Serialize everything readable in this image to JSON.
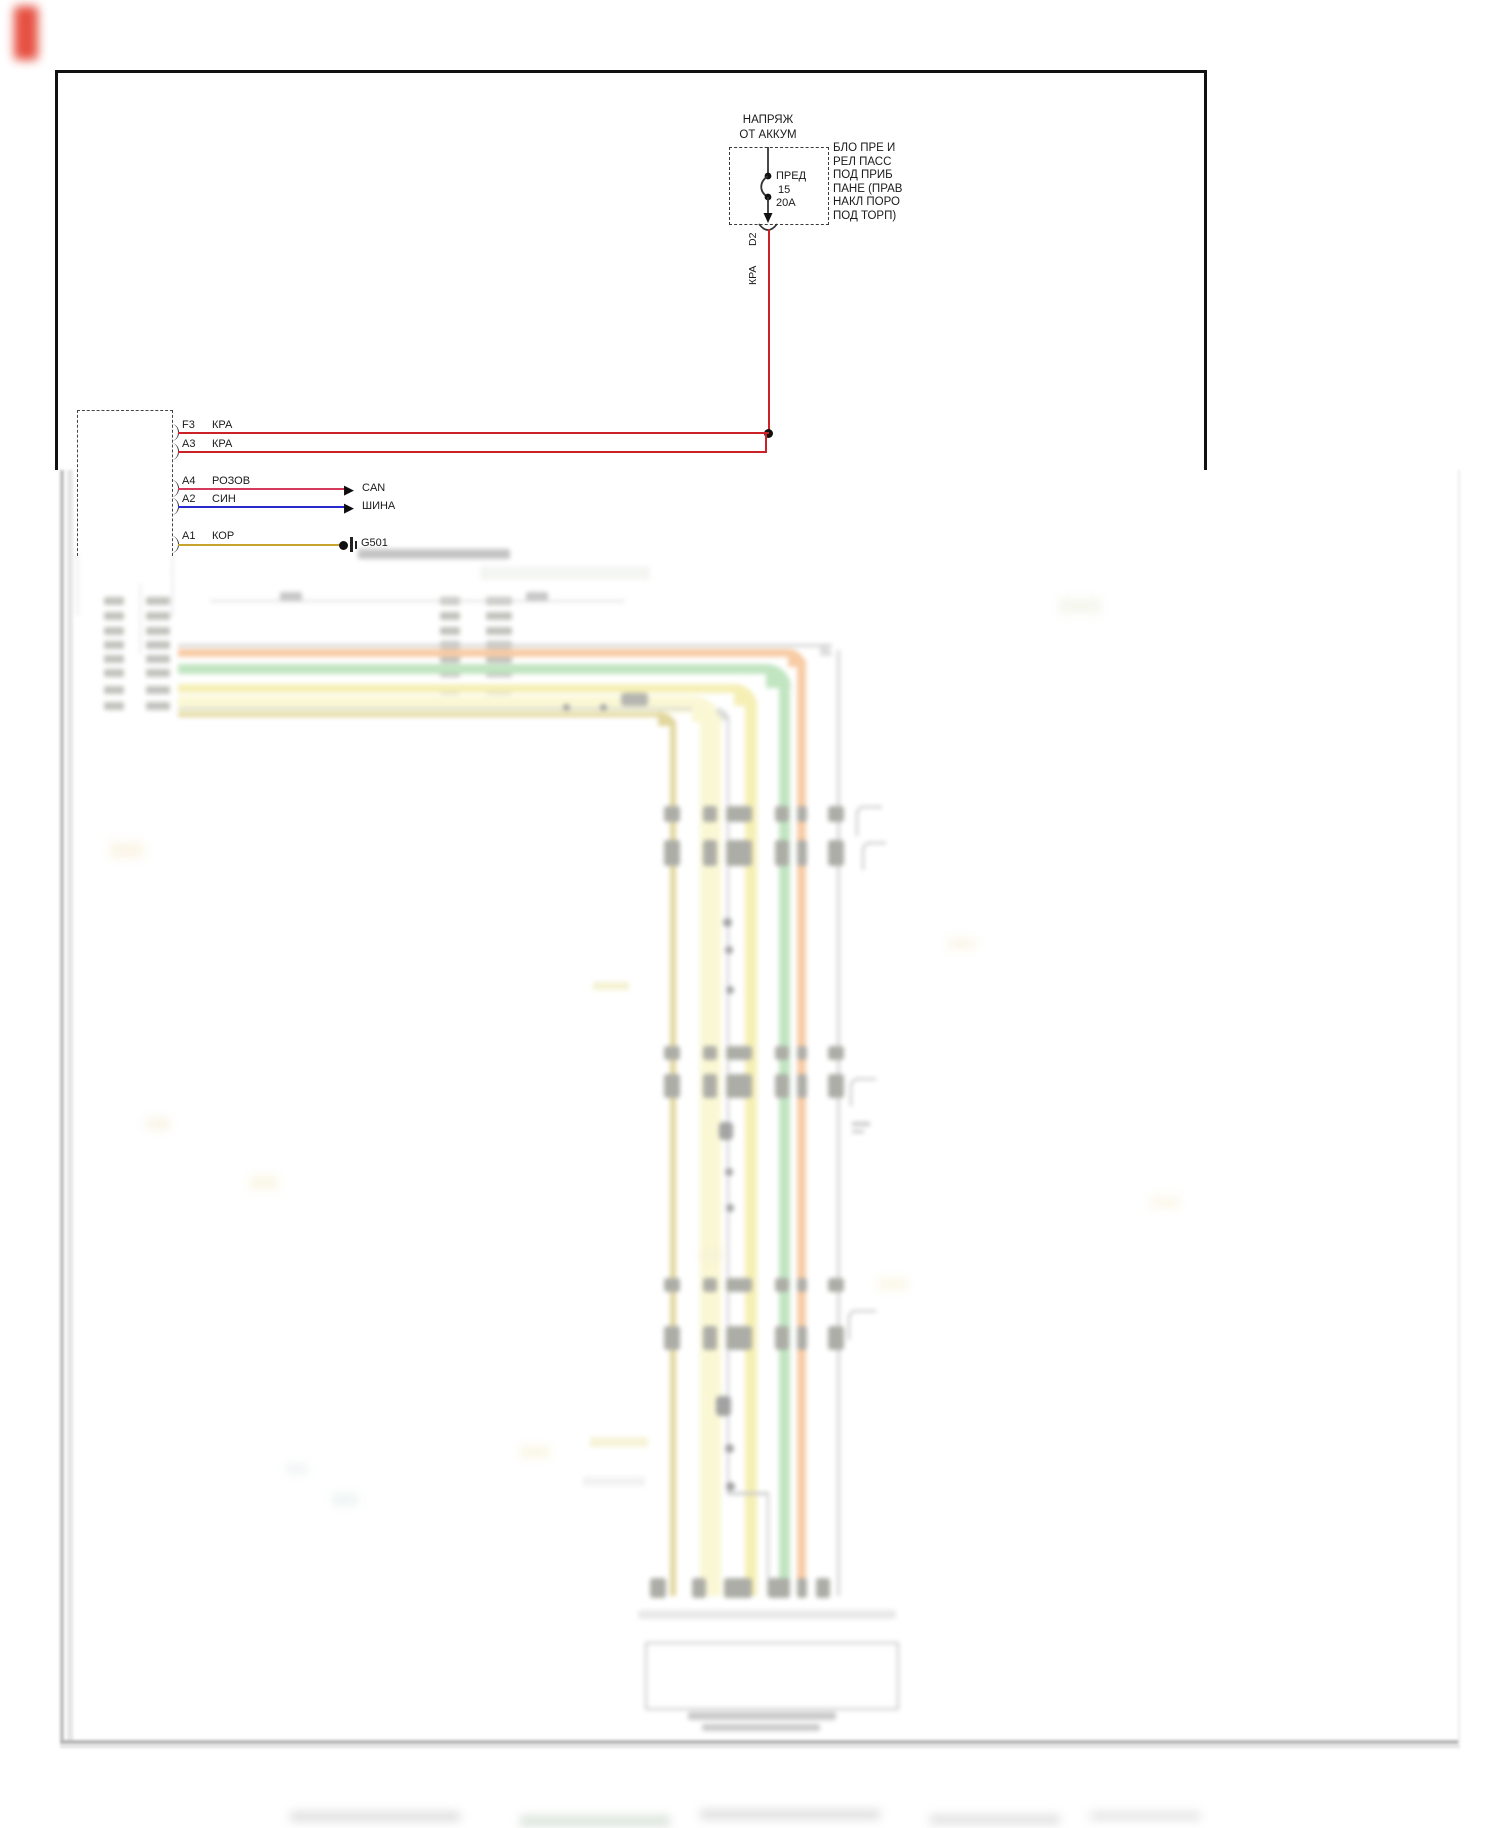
{
  "diagram": {
    "power_source": {
      "line1": "НАПРЯЖ",
      "line2": "ОТ АККУМ"
    },
    "fuse": {
      "name": "ПРЕД",
      "number": "15",
      "rating": "20A"
    },
    "fuse_box_note": {
      "line1": "БЛО ПРЕ И",
      "line2": "РЕЛ ПАСС",
      "line3": "ПОД ПРИБ",
      "line4": "ПАНЕ (ПРАВ",
      "line5": "НАКЛ ПОРО",
      "line6": "ПОД ТОРП)"
    },
    "feed_wire": {
      "pin": "D2",
      "color_label": "КРА",
      "color_hex": "#cc2127"
    },
    "pins": [
      {
        "pin": "F3",
        "color_label": "КРА",
        "dest": ""
      },
      {
        "pin": "A3",
        "color_label": "КРА",
        "dest": ""
      },
      {
        "pin": "A4",
        "color_label": "РОЗОВ",
        "dest": "CAN"
      },
      {
        "pin": "A2",
        "color_label": "СИН",
        "dest": "ШИНА"
      },
      {
        "pin": "A1",
        "color_label": "КОР",
        "dest": "G501"
      }
    ],
    "ground_label": "G501",
    "icons": {
      "can_arrow": "▶",
      "bus_arrow": "▶"
    },
    "wire_colors": {
      "red": "#cc2127",
      "pink": "#d63a5a",
      "blue": "#2a2acc",
      "brown_yellow": "#c7a22d"
    },
    "highlight_colors": {
      "orange": "#f2a25c",
      "green": "#8fd08f",
      "yellow": "#eee27a",
      "pale_yellow": "#f6f2b2",
      "khaki": "#c9b54d",
      "gray": "#b3b3b3"
    }
  }
}
